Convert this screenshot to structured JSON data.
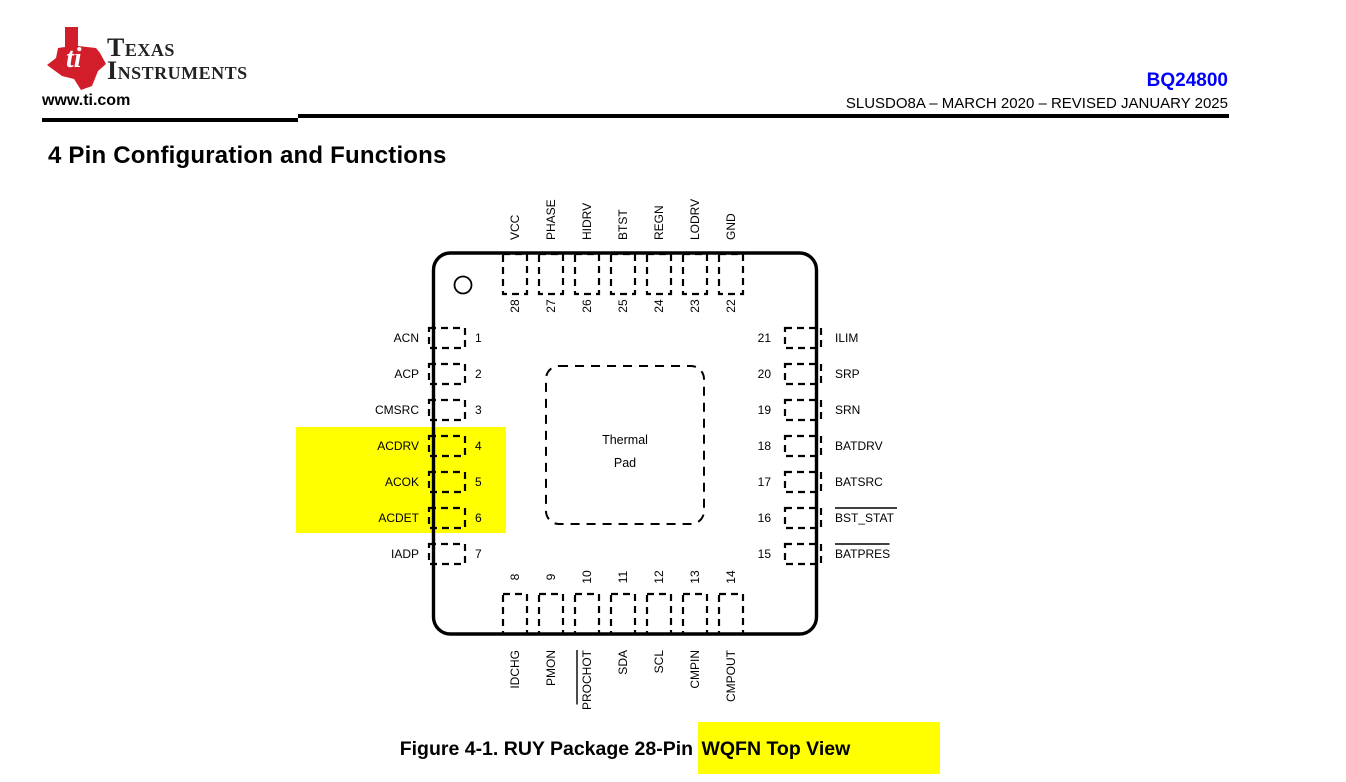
{
  "header": {
    "logo_monogram": "ti",
    "brand_line1": "Texas",
    "brand_line2": "Instruments",
    "website": "www.ti.com",
    "part_number": "BQ24800",
    "doc_revision": "SLUSDO8A – MARCH 2020 – REVISED JANUARY 2025"
  },
  "section": {
    "title": "4 Pin Configuration and Functions"
  },
  "figure": {
    "caption_prefix": "Figure 4-1. RUY Package 28-Pin ",
    "caption_highlight": "WQFN Top View",
    "thermal_pad_line1": "Thermal",
    "thermal_pad_line2": "Pad"
  },
  "package": {
    "name": "RUY 28-Pin WQFN",
    "pins": {
      "top": [
        {
          "num": "28",
          "name": "VCC"
        },
        {
          "num": "27",
          "name": "PHASE"
        },
        {
          "num": "26",
          "name": "HIDRV"
        },
        {
          "num": "25",
          "name": "BTST"
        },
        {
          "num": "24",
          "name": "REGN"
        },
        {
          "num": "23",
          "name": "LODRV"
        },
        {
          "num": "22",
          "name": "GND"
        }
      ],
      "left": [
        {
          "num": "1",
          "name": "ACN"
        },
        {
          "num": "2",
          "name": "ACP"
        },
        {
          "num": "3",
          "name": "CMSRC"
        },
        {
          "num": "4",
          "name": "ACDRV",
          "highlighted": true
        },
        {
          "num": "5",
          "name": "ACOK",
          "highlighted": true
        },
        {
          "num": "6",
          "name": "ACDET",
          "highlighted": true
        },
        {
          "num": "7",
          "name": "IADP"
        }
      ],
      "right": [
        {
          "num": "21",
          "name": "ILIM"
        },
        {
          "num": "20",
          "name": "SRP"
        },
        {
          "num": "19",
          "name": "SRN"
        },
        {
          "num": "18",
          "name": "BATDRV"
        },
        {
          "num": "17",
          "name": "BATSRC"
        },
        {
          "num": "16",
          "name": "BST_STAT",
          "overline": true
        },
        {
          "num": "15",
          "name": "BATPRES",
          "overline": true
        }
      ],
      "bottom": [
        {
          "num": "8",
          "name": "IDCHG"
        },
        {
          "num": "9",
          "name": "PMON"
        },
        {
          "num": "10",
          "name": "PROCHOT",
          "overline": true
        },
        {
          "num": "11",
          "name": "SDA"
        },
        {
          "num": "12",
          "name": "SCL"
        },
        {
          "num": "13",
          "name": "CMPIN"
        },
        {
          "num": "14",
          "name": "CMPOUT"
        }
      ]
    }
  },
  "colors": {
    "ti_red": "#d21e2b",
    "part_link_blue": "#0000ff",
    "highlight_yellow": "#ffff00",
    "ink_black": "#000000"
  }
}
